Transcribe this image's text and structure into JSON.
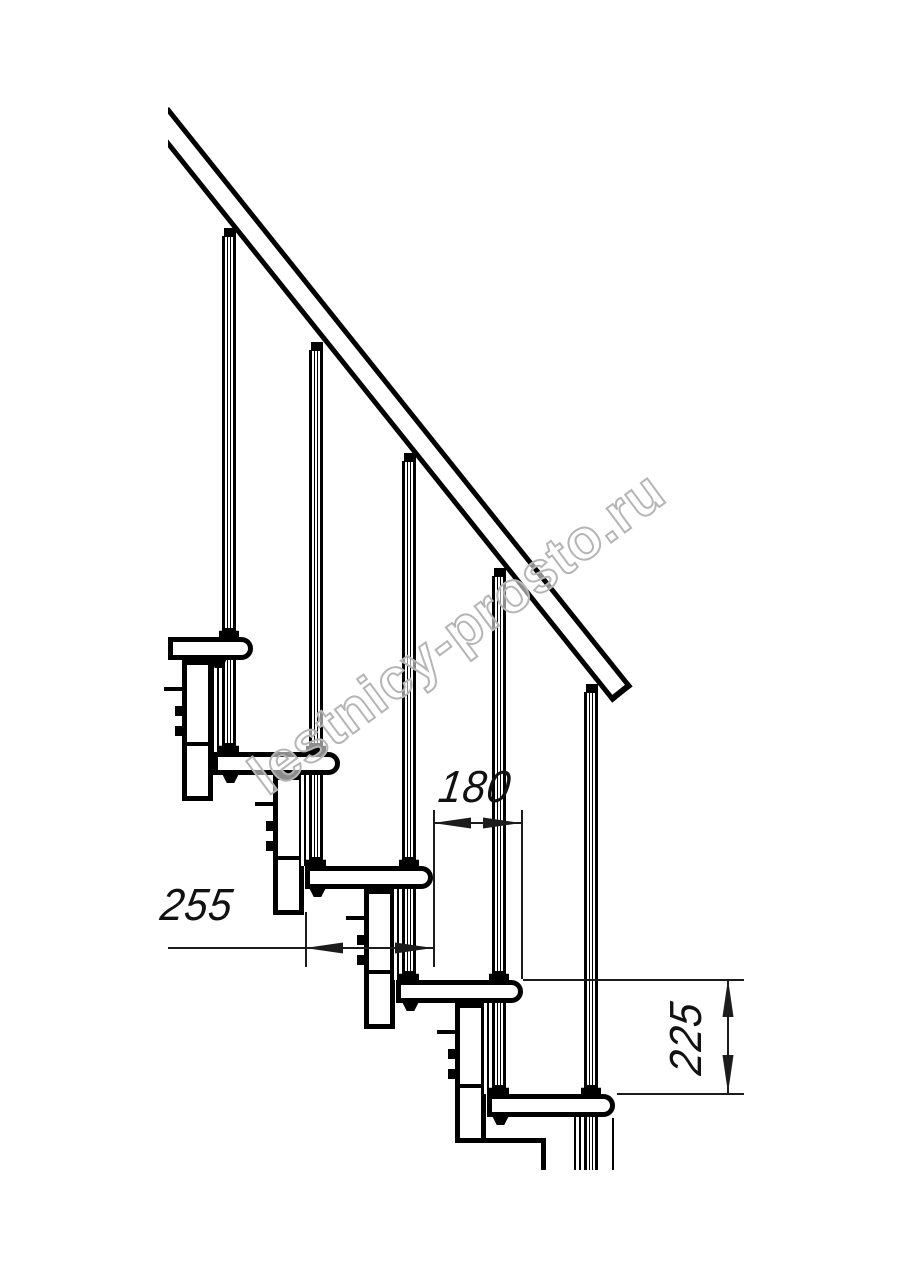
{
  "watermark": {
    "text": "lestnicy-prosto.ru"
  },
  "drawing": {
    "title_semantic": "modular-staircase-side-view",
    "stroke_color": "#000000",
    "dim_color": "#1c1c1c",
    "dimensions": {
      "step_nose_spacing": {
        "value": "180",
        "orientation": "horizontal"
      },
      "tread_depth": {
        "value": "255",
        "orientation": "horizontal"
      },
      "step_rise": {
        "value": "225",
        "orientation": "vertical"
      }
    },
    "tread_height": 23,
    "steps": [
      {
        "left": 168,
        "nose": 253,
        "top": 637,
        "cap_y": 228
      },
      {
        "left": 213,
        "nose": 340,
        "top": 752,
        "cap_y": 342
      },
      {
        "left": 305,
        "nose": 433,
        "top": 866,
        "cap_y": 453
      },
      {
        "left": 396,
        "nose": 523,
        "top": 980,
        "cap_y": 568
      },
      {
        "left": 487,
        "nose": 615,
        "top": 1094,
        "cap_y": 684
      }
    ],
    "modules": [
      {
        "box_left": 182,
        "box_top": 660,
        "box_bottom": 801
      },
      {
        "box_left": 273,
        "box_top": 775,
        "box_bottom": 915
      },
      {
        "box_left": 364,
        "box_top": 889,
        "box_bottom": 1029
      },
      {
        "box_left": 455,
        "box_top": 1003,
        "box_bottom": 1143
      }
    ],
    "cutoff_y": 1170,
    "dim_geometry": {
      "d180": {
        "line_y": 822,
        "x1": 433,
        "x2": 521,
        "ext1": [
          433,
          810,
          967
        ],
        "ext2": [
          521,
          810,
          979
        ]
      },
      "d255": {
        "line_y": 947,
        "x1": 305,
        "x2": 433,
        "leader_x": 168,
        "ext": [
          305,
          912,
          967
        ]
      },
      "d225": {
        "line_x": 727,
        "y1": 979,
        "y2": 1093,
        "ext_top": [
          523,
          744,
          979
        ],
        "ext_bottom": [
          617,
          744,
          1093
        ]
      }
    }
  }
}
